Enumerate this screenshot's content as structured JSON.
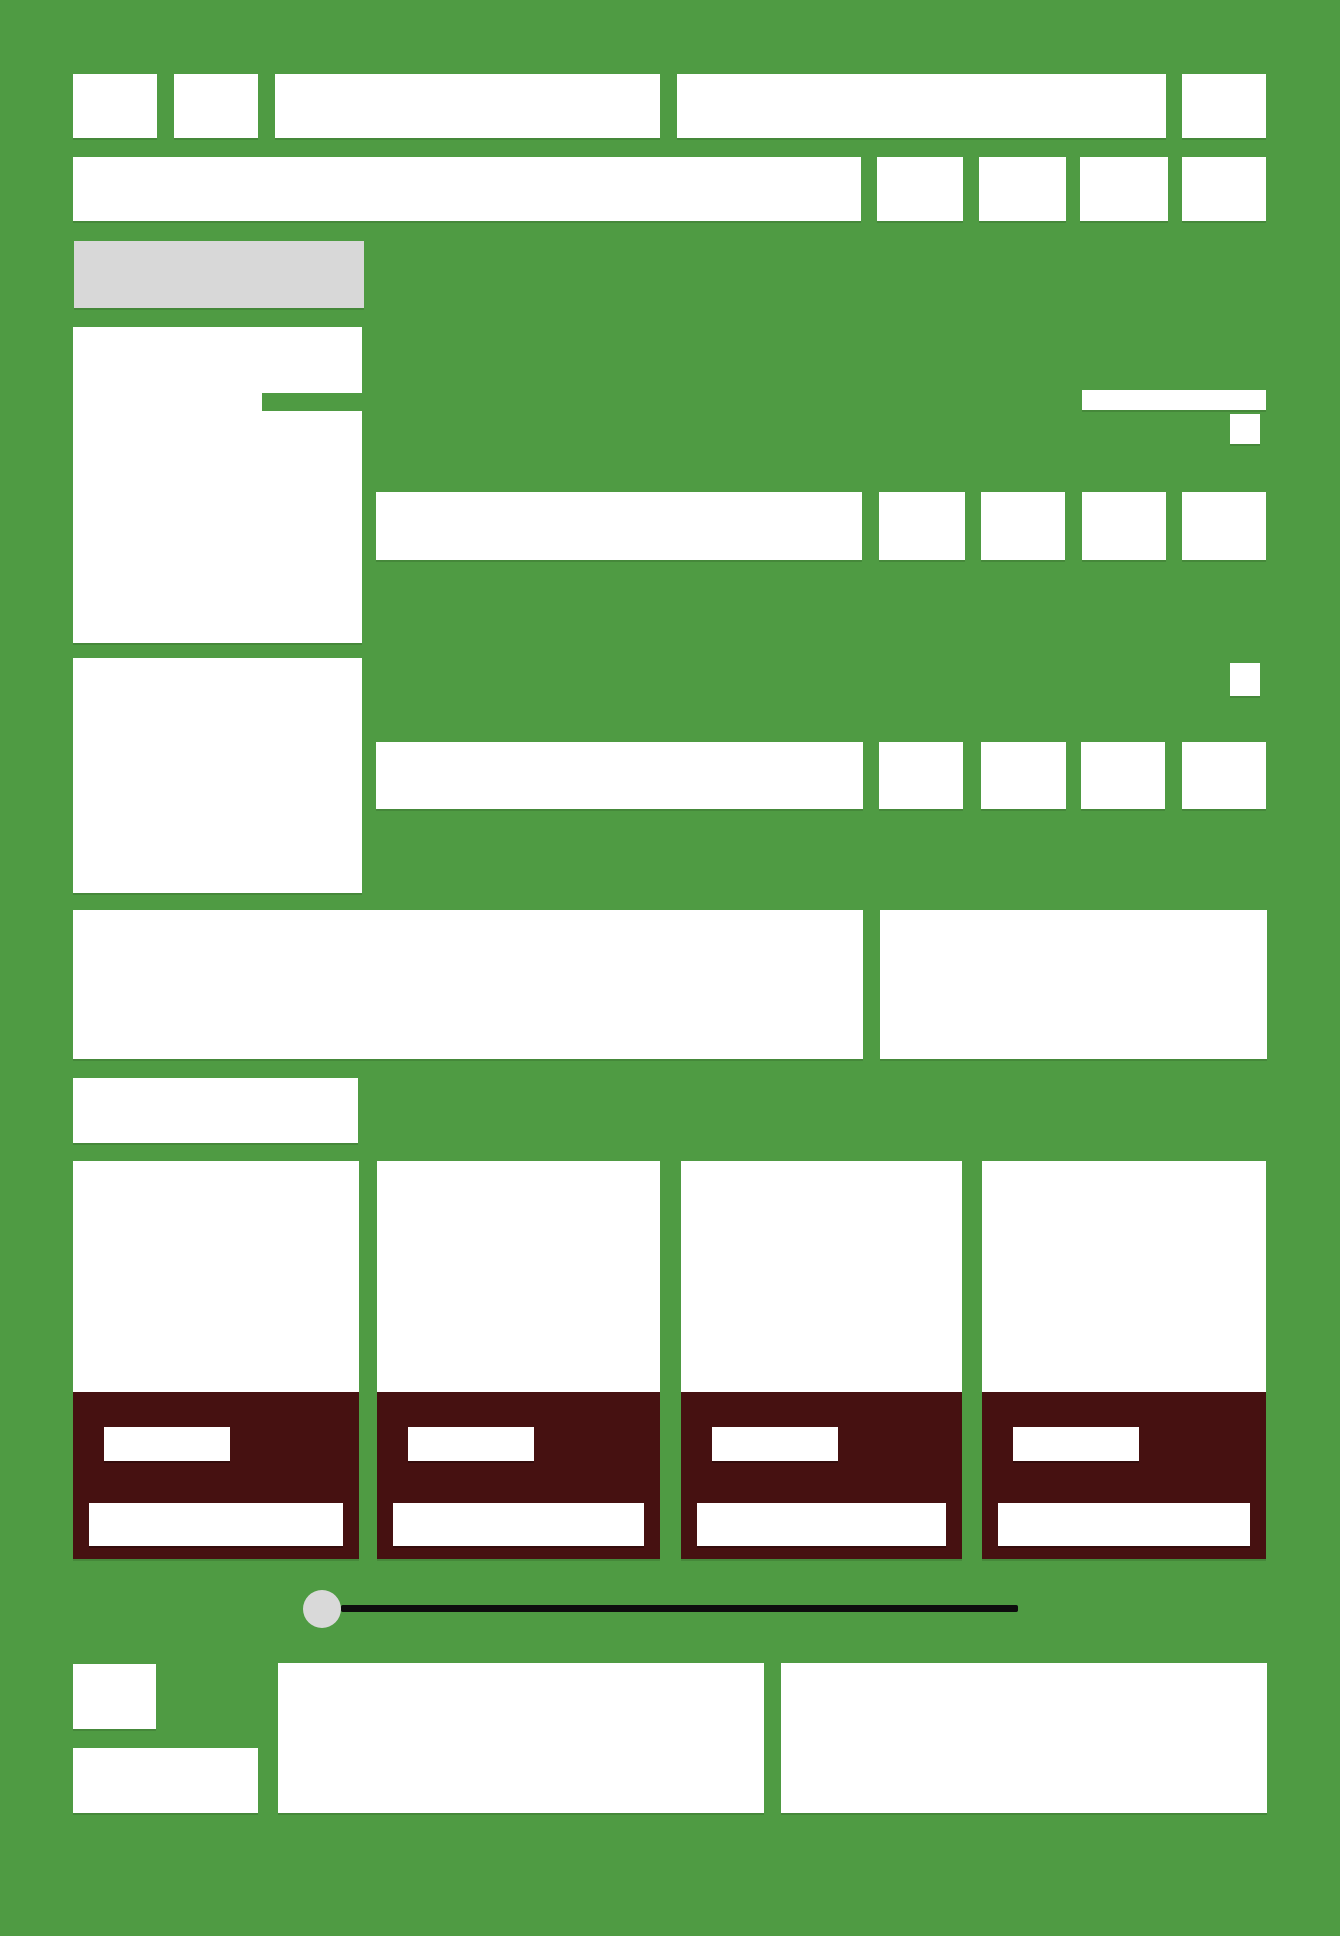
{
  "canvas": {
    "width": 1340,
    "height": 1936
  },
  "palette": {
    "background": "#4f9b43",
    "surface": "#ffffff",
    "muted_label": "#d8d8d8",
    "accent_dark": "#461111",
    "slider_track": "#0e0e0e",
    "slider_handle": "#d9d9d9"
  },
  "header": {
    "block_count": 5
  },
  "toolbar": {
    "button_count": 4
  },
  "list_rows": {
    "count": 2,
    "buttons_per_row": 4
  },
  "side_cards": {
    "count": 2
  },
  "card_grid": {
    "card_count": 4,
    "chips_per_card": 1,
    "bars_per_card": 1
  },
  "slider": {
    "handle_position": "start"
  },
  "footer": {
    "thumb_count": 2,
    "panel_count": 2
  }
}
